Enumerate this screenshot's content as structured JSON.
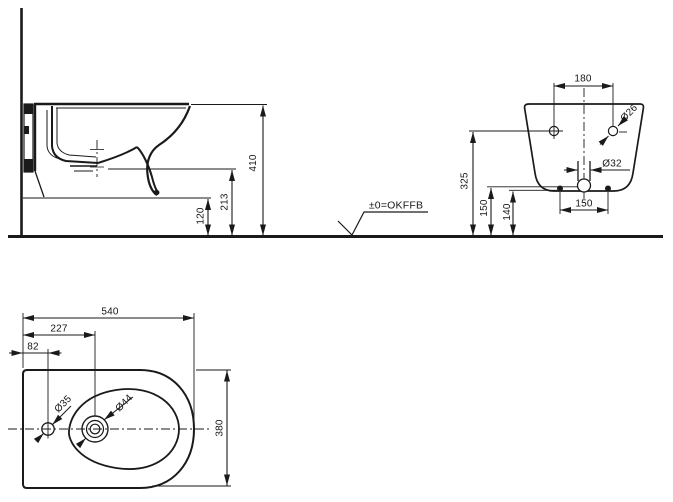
{
  "drawing": {
    "datum_label": "±0=OKFFB",
    "side_view": {
      "total_height_mm": "410",
      "outlet_height_mm": "213",
      "clearance_mm": "120"
    },
    "rear_view": {
      "top_hole_spacing_mm": "180",
      "top_hole_diameter": "Ø26",
      "outlet_diameter": "Ø32",
      "top_hole_height_mm": "325",
      "supply_height_mm": "150",
      "fixing_height_mm": "140",
      "bottom_fixing_spacing_mm": "150"
    },
    "plan_view": {
      "depth_mm": "540",
      "outlet_offset_mm": "227",
      "tap_offset_mm": "82",
      "tap_hole_diameter": "Ø35",
      "outlet_hole_diameter": "Ø44",
      "width_mm": "380"
    }
  }
}
